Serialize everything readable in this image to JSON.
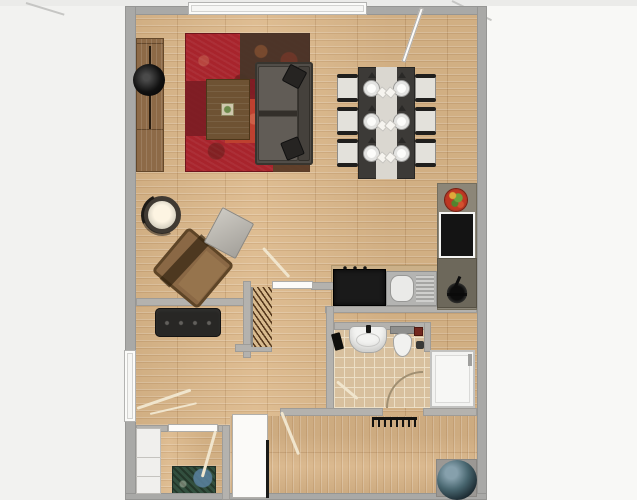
{
  "scene": {
    "label": "apartment-floor-plan",
    "canvas_w": 637,
    "canvas_h": 500
  },
  "palette": {
    "exterior": "#f2f2f0",
    "wall_outer": "#a9a9a7",
    "wall_inner": "#b4b2ae",
    "wood_floor": "#dcb88a",
    "bathroom_tile": "#d8c09e",
    "living_rug": "#a8242c",
    "sofa": "#514d48",
    "kitchen_counter": "#8c8678",
    "appliance_black": "#141414",
    "fixture_white": "#f3f3f1",
    "pouf": "#48666f"
  },
  "rooms": [
    {
      "name": "living-room"
    },
    {
      "name": "dining-area"
    },
    {
      "name": "kitchen"
    },
    {
      "name": "hallway-with-coat-niche"
    },
    {
      "name": "bathroom"
    },
    {
      "name": "shower-corner"
    },
    {
      "name": "bottom-left-room"
    },
    {
      "name": "bottom-right-entrance-room"
    }
  ],
  "items": [
    {
      "t": "ext",
      "n": "exterior-right",
      "x": 487,
      "y": 0,
      "w": 150,
      "h": 500
    },
    {
      "t": "ext2",
      "n": "exterior-top-band",
      "x": 0,
      "y": 0,
      "w": 637,
      "h": 6
    },
    {
      "t": "diag",
      "n": "exterior-line-topleft",
      "x": 26,
      "y": 2,
      "w": 40,
      "h": 2,
      "r": 17,
      "o": "0 50%"
    },
    {
      "t": "diag",
      "n": "exterior-line-topright",
      "x": 452,
      "y": 0,
      "w": 44,
      "h": 2,
      "r": 26,
      "o": "0 50%"
    },
    {
      "t": "floor-wood-h",
      "n": "floor-living-dining",
      "x": 136,
      "y": 14,
      "w": 341,
      "h": 411
    },
    {
      "t": "floor-wood-h",
      "n": "floor-bottom-left-room",
      "x": 136,
      "y": 425,
      "w": 94,
      "h": 69
    },
    {
      "t": "floor-wood-v",
      "n": "floor-bottom-right-room",
      "x": 230,
      "y": 416,
      "w": 247,
      "h": 78
    },
    {
      "t": "floor-tile",
      "n": "floor-bathroom",
      "x": 334,
      "y": 330,
      "w": 96,
      "h": 78
    },
    {
      "t": "counter",
      "n": "kitchen-counter-bottom",
      "x": 331,
      "y": 265,
      "w": 146,
      "h": 42
    },
    {
      "t": "rug-red",
      "n": "living-room-rug",
      "x": 185,
      "y": 33,
      "w": 125,
      "h": 139,
      "ch": [
        {
          "t": "patch patch-b",
          "n": "rug-patch",
          "x": 55,
          "y": 0,
          "w": 70,
          "h": 46
        },
        {
          "t": "patch patch-a",
          "n": "rug-patch",
          "x": 0,
          "y": 48,
          "w": 40,
          "h": 55
        },
        {
          "t": "patch patch-c",
          "n": "rug-patch",
          "x": 40,
          "y": 62,
          "w": 58,
          "h": 48
        },
        {
          "t": "patch patch-d",
          "n": "rug-patch",
          "x": 88,
          "y": 108,
          "w": 37,
          "h": 31
        },
        {
          "t": "patch patch-a",
          "n": "rug-patch",
          "x": 60,
          "y": 46,
          "w": 28,
          "h": 20
        }
      ]
    },
    {
      "t": "rug-dark",
      "n": "doormat-rug",
      "x": 172,
      "y": 466,
      "w": 44,
      "h": 30
    },
    {
      "t": "wall",
      "n": "wall-top",
      "x": 125,
      "y": 6,
      "w": 362,
      "h": 9
    },
    {
      "t": "wall",
      "n": "wall-left",
      "x": 125,
      "y": 6,
      "w": 11,
      "h": 494
    },
    {
      "t": "wall",
      "n": "wall-right",
      "x": 477,
      "y": 6,
      "w": 10,
      "h": 494
    },
    {
      "t": "wall",
      "n": "wall-bottom",
      "x": 125,
      "y": 493,
      "w": 362,
      "h": 7
    },
    {
      "t": "wall-i",
      "n": "wall-hallway-top",
      "x": 136,
      "y": 298,
      "w": 115,
      "h": 8
    },
    {
      "t": "wall-i",
      "n": "wall-coat-niche-left",
      "x": 243,
      "y": 281,
      "w": 8,
      "h": 77
    },
    {
      "t": "wall-i",
      "n": "wall-coat-niche-bottom",
      "x": 235,
      "y": 344,
      "w": 37,
      "h": 8
    },
    {
      "t": "wall-i",
      "n": "wall-living-stub",
      "x": 311,
      "y": 282,
      "w": 23,
      "h": 8
    },
    {
      "t": "wall-i",
      "n": "wall-kitchen-bottom",
      "x": 325,
      "y": 306,
      "w": 152,
      "h": 7
    },
    {
      "t": "wall-i",
      "n": "wall-bathroom-left",
      "x": 326,
      "y": 306,
      "w": 8,
      "h": 110
    },
    {
      "t": "wall-i",
      "n": "wall-bathroom-top",
      "x": 334,
      "y": 322,
      "w": 96,
      "h": 8
    },
    {
      "t": "wall-i",
      "n": "wall-bath-shower-divider",
      "x": 424,
      "y": 322,
      "w": 7,
      "h": 30
    },
    {
      "t": "wall-i",
      "n": "wall-lower-left",
      "x": 280,
      "y": 408,
      "w": 103,
      "h": 8
    },
    {
      "t": "wall-i",
      "n": "wall-lower-right",
      "x": 423,
      "y": 408,
      "w": 54,
      "h": 8
    },
    {
      "t": "wall-i",
      "n": "wall-bottomleft-room-a",
      "x": 136,
      "y": 425,
      "w": 32,
      "h": 7
    },
    {
      "t": "wall-i",
      "n": "wall-bottomleft-room-b",
      "x": 218,
      "y": 425,
      "w": 12,
      "h": 7
    },
    {
      "t": "wall-i",
      "n": "wall-bottom-rooms-divider",
      "x": 222,
      "y": 425,
      "w": 8,
      "h": 75
    },
    {
      "t": "window",
      "n": "window-top",
      "x": 188,
      "y": 2,
      "w": 179,
      "h": 13
    },
    {
      "t": "window",
      "n": "window-left",
      "x": 124,
      "y": 350,
      "w": 12,
      "h": 72
    },
    {
      "t": "sideboard",
      "n": "sideboard",
      "x": 136,
      "y": 38,
      "w": 28,
      "h": 134
    },
    {
      "t": "tv",
      "n": "tv-disc",
      "x": 133,
      "y": 64,
      "w": 32,
      "h": 32
    },
    {
      "t": "coffee-table",
      "n": "coffee-table",
      "x": 206,
      "y": 79,
      "w": 44,
      "h": 61
    },
    {
      "t": "sofa",
      "n": "sofa",
      "x": 255,
      "y": 62,
      "w": 58,
      "h": 103,
      "ch": [
        {
          "t": "pillow",
          "n": "sofa-pillow",
          "x": 30,
          "y": 5,
          "w": 19,
          "h": 19,
          "r": 28
        },
        {
          "t": "pillow",
          "n": "sofa-pillow",
          "x": 28,
          "y": 77,
          "w": 19,
          "h": 19,
          "r": -22
        }
      ]
    },
    {
      "t": "lamp",
      "n": "floor-lamp",
      "x": 143,
      "y": 196,
      "w": 38,
      "h": 38
    },
    {
      "t": "armchair",
      "n": "armchair",
      "x": 163,
      "y": 239,
      "w": 60,
      "h": 58,
      "r": 40
    },
    {
      "t": "side-table",
      "n": "side-table",
      "x": 211,
      "y": 213,
      "w": 36,
      "h": 40,
      "r": 28
    },
    {
      "t": "dining-table",
      "n": "dining-table",
      "x": 358,
      "y": 67,
      "w": 57,
      "h": 112,
      "ch": [
        {
          "t": "plate-l",
          "n": "place-setting",
          "x": 5,
          "y": 13,
          "w": 17,
          "h": 17
        },
        {
          "t": "plate-l",
          "n": "place-setting",
          "x": 5,
          "y": 46,
          "w": 17,
          "h": 17
        },
        {
          "t": "plate-l",
          "n": "place-setting",
          "x": 5,
          "y": 78,
          "w": 17,
          "h": 17
        },
        {
          "t": "plate-r",
          "n": "place-setting",
          "x": 35,
          "y": 13,
          "w": 17,
          "h": 17
        },
        {
          "t": "plate-r",
          "n": "place-setting",
          "x": 35,
          "y": 46,
          "w": 17,
          "h": 17
        },
        {
          "t": "plate-r",
          "n": "place-setting",
          "x": 35,
          "y": 78,
          "w": 17,
          "h": 17
        }
      ]
    },
    {
      "t": "chair",
      "n": "dining-chair",
      "x": 337,
      "y": 76,
      "w": 21,
      "h": 24
    },
    {
      "t": "chair",
      "n": "dining-chair",
      "x": 337,
      "y": 109,
      "w": 21,
      "h": 24
    },
    {
      "t": "chair",
      "n": "dining-chair",
      "x": 337,
      "y": 141,
      "w": 21,
      "h": 24
    },
    {
      "t": "chair",
      "n": "dining-chair",
      "x": 415,
      "y": 76,
      "w": 21,
      "h": 24
    },
    {
      "t": "chair",
      "n": "dining-chair",
      "x": 415,
      "y": 109,
      "w": 21,
      "h": 24
    },
    {
      "t": "chair",
      "n": "dining-chair",
      "x": 415,
      "y": 141,
      "w": 21,
      "h": 24
    },
    {
      "t": "counter-g",
      "n": "kitchen-counter-right",
      "x": 437,
      "y": 183,
      "w": 40,
      "h": 127
    },
    {
      "t": "fruit-bowl",
      "n": "fruit-bowl",
      "x": 445,
      "y": 189,
      "w": 22,
      "h": 22
    },
    {
      "t": "oven",
      "n": "appliance-black",
      "x": 439,
      "y": 212,
      "w": 36,
      "h": 46
    },
    {
      "t": "corner-unit",
      "n": "kitchen-corner-unit",
      "x": 437,
      "y": 258,
      "w": 40,
      "h": 50,
      "ch": [
        {
          "t": "kfaucet",
          "n": "kitchen-faucet",
          "x": 7,
          "y": 20,
          "w": 26,
          "h": 26
        }
      ]
    },
    {
      "t": "cooktop",
      "n": "cooktop",
      "x": 333,
      "y": 269,
      "w": 53,
      "h": 37
    },
    {
      "t": "sink",
      "n": "kitchen-sink",
      "x": 386,
      "y": 271,
      "w": 51,
      "h": 35
    },
    {
      "t": "bench",
      "n": "hallway-bench",
      "x": 155,
      "y": 308,
      "w": 66,
      "h": 29
    },
    {
      "t": "hangers",
      "n": "coat-rack",
      "x": 251,
      "y": 287,
      "w": 21,
      "h": 60
    },
    {
      "t": "bsink",
      "n": "bathroom-sink",
      "x": 349,
      "y": 326,
      "w": 38,
      "h": 27
    },
    {
      "t": "toilet",
      "n": "toilet",
      "x": 390,
      "y": 326,
      "w": 25,
      "h": 31
    },
    {
      "t": "reditem",
      "n": "bathroom-shelf-item",
      "x": 414,
      "y": 327,
      "w": 9,
      "h": 9
    },
    {
      "t": "blackitem",
      "n": "bathroom-fixture",
      "x": 333,
      "y": 333,
      "w": 9,
      "h": 17,
      "r": -15
    },
    {
      "t": "smallitem",
      "n": "toilet-brush",
      "x": 416,
      "y": 341,
      "w": 8,
      "h": 8
    },
    {
      "t": "shower",
      "n": "shower",
      "x": 430,
      "y": 350,
      "w": 45,
      "h": 58
    },
    {
      "t": "radiator",
      "n": "radiator",
      "x": 372,
      "y": 417,
      "w": 45,
      "h": 10
    },
    {
      "t": "wardrobe",
      "n": "wardrobe-white",
      "x": 136,
      "y": 428,
      "w": 25,
      "h": 66
    },
    {
      "t": "panel",
      "n": "open-door-panel",
      "x": 232,
      "y": 414,
      "w": 36,
      "h": 84
    },
    {
      "t": "edge",
      "n": "door-edge-line",
      "x": 266,
      "y": 440,
      "w": 3,
      "h": 58
    },
    {
      "t": "pouf-mat",
      "n": "pouf-mat",
      "x": 436,
      "y": 459,
      "w": 41,
      "h": 38
    },
    {
      "t": "pouf",
      "n": "floor-pouf",
      "x": 437,
      "y": 460,
      "w": 40,
      "h": 40
    },
    {
      "t": "leaf",
      "n": "door-leaf-top-right",
      "x": 420,
      "y": 8,
      "w": 4,
      "h": 57,
      "r": 19,
      "o": "50% 0"
    },
    {
      "t": "leaf",
      "n": "door-leaf-living-hall",
      "x": 272,
      "y": 281,
      "w": 41,
      "h": 8
    },
    {
      "t": "swing",
      "n": "door-swing-living",
      "x": 262,
      "y": 249,
      "w": 3,
      "h": 39,
      "r": -42,
      "o": "0 0"
    },
    {
      "t": "swing",
      "n": "door-swing-hallway",
      "x": 137,
      "y": 407,
      "w": 57,
      "h": 3,
      "r": -19,
      "o": "0 50%"
    },
    {
      "t": "swing",
      "n": "door-swing-hallway-2",
      "x": 150,
      "y": 413,
      "w": 48,
      "h": 2,
      "r": -13,
      "o": "0 50%"
    },
    {
      "t": "leaf",
      "n": "door-leaf-bottomleft",
      "x": 168,
      "y": 424,
      "w": 50,
      "h": 8
    },
    {
      "t": "swing",
      "n": "door-swing-bottomleft",
      "x": 214,
      "y": 431,
      "w": 3,
      "h": 48,
      "r": 16,
      "o": "50% 0"
    },
    {
      "t": "swing",
      "n": "door-swing-bottomright",
      "x": 280,
      "y": 412,
      "w": 3,
      "h": 46,
      "r": -22,
      "o": "50% 0"
    },
    {
      "t": "swing",
      "n": "door-swing-bathroom",
      "x": 337,
      "y": 380,
      "w": 27,
      "h": 3,
      "r": 40,
      "o": "0 50%"
    },
    {
      "t": "arc",
      "n": "door-arc-bathroom",
      "x": 386,
      "y": 371,
      "w": 37,
      "h": 37
    }
  ]
}
